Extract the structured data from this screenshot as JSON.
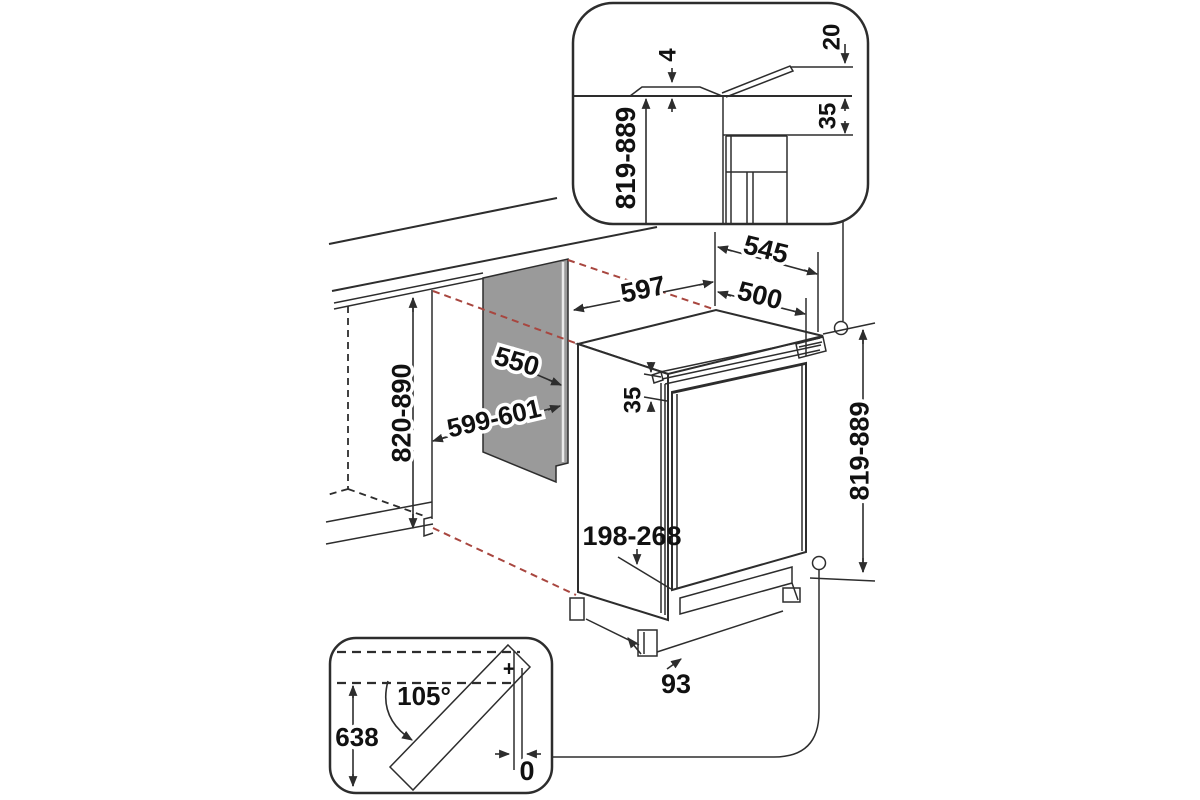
{
  "colors": {
    "line": "#2d2d2d",
    "panel_gray": "#9a9a9a",
    "door_gray": "#d4d4d4",
    "projection_red": "#a8463f",
    "background": "#ffffff"
  },
  "labels": {
    "top_inset": {
      "deflector_thickness": "4",
      "deflector_rise": "20",
      "top_clearance": "35",
      "height_range": "819-889"
    },
    "main": {
      "appliance_width": "597",
      "total_depth": "545",
      "door_depth": "500",
      "panel_depth": "550",
      "niche_width": "599-601",
      "niche_height": "820-890",
      "door_top_offset": "35",
      "overall_height": "819-889",
      "plinth_height_range": "198-268",
      "base_recess": "93"
    },
    "door_inset": {
      "opening_angle": "105°",
      "door_height": "638",
      "side_clearance": "0",
      "hinge_mark": "+"
    }
  }
}
